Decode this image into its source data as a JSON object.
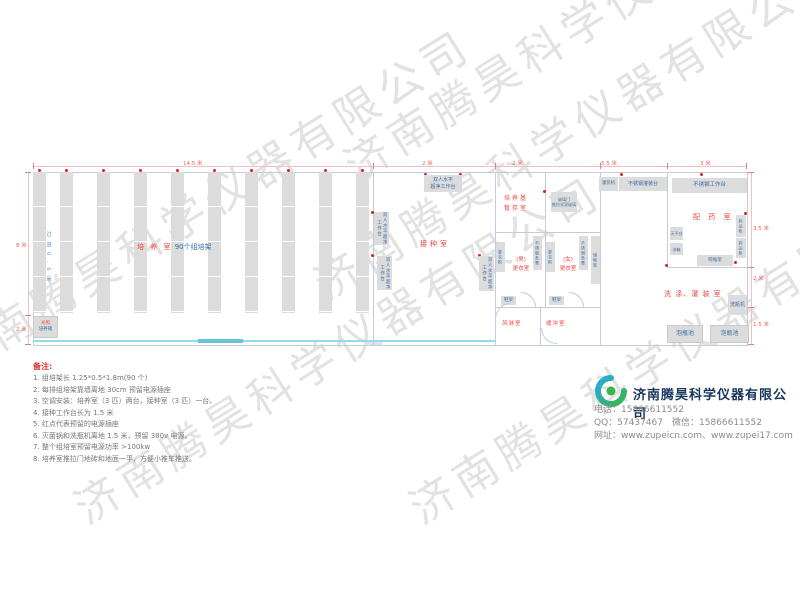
{
  "watermark": "济南腾昊科学仪器有限公司",
  "colors": {
    "room_label_red": "#f24545",
    "equipment_blue": "#3a6ea5",
    "dimension_red": "#e86060",
    "sliding_door_cyan": "#8fdde8",
    "company_navy": "#17365d",
    "logo_blue": "#29abe2",
    "logo_green": "#39b54a"
  },
  "plan": {
    "dims": {
      "top": [
        "14.5 米",
        "2 米",
        "2 米",
        "5.5 米",
        "3 米"
      ],
      "left": [
        "8 米",
        "2 米"
      ],
      "right": [
        "3.5 米",
        "2 米",
        "1.5 米"
      ]
    },
    "culture": {
      "name": "培 养 室",
      "racks": "90个组培架",
      "aisle": "过道0.6米",
      "incubator1": "光照",
      "incubator2": "培养箱"
    },
    "inoculation": {
      "name": "接种室",
      "bench1": "双人水平",
      "bench2": "超净工作台",
      "bench_v": "双人水平超净工作台"
    },
    "medium_storage": {
      "line1": "培养基",
      "line2": "暂存室"
    },
    "glass_door": {
      "line1": "玻璃门",
      "line2": "推拉式双玻璃"
    },
    "changing": {
      "wardrobe": "更衣柜",
      "steel_bench": "不锈钢条凳",
      "men1": "(男)",
      "men2": "更衣室",
      "women1": "(女)",
      "women2": "更衣室",
      "shoe_rack": "鞋架",
      "storage_rack": "储物架",
      "air_shower": "风淋室",
      "buffer": "缓冲室"
    },
    "pharmacy": {
      "name": "配 药 室",
      "filling_machine": "灌装机",
      "filling_table": "不锈钢灌装台",
      "work_table": "不锈钢工作台",
      "balance_table": "天平台",
      "fridge": "冰箱",
      "medicine_cabinet": "药品柜",
      "bottle_rack": "晾瓶架"
    },
    "washing": {
      "name": "洗 涤、灌 装 室",
      "bottle_washer": "洗瓶机",
      "soak_pool": "泡瓶池"
    }
  },
  "notes": {
    "title": "备注:",
    "items": [
      "1. 组培架长 1.25*0.5*1.8m(90 个)",
      "2. 每排组培架靠墙离地 30cm 预留电源插座",
      "3. 空调安装：培养室（3 匹）两台，接种室（3 匹）一台。",
      "4. 接种工作台长为 1.5 米",
      "5. 红点代表预留的电源插座",
      "6. 灭菌锅和洗瓶机离地 1.5 米，预留 380v 电源。",
      "7. 整个组培室预留电源功率 >100kw",
      "8. 培养室推拉门地砖和地面一平，方便小推车推送。"
    ]
  },
  "company": {
    "name": "济南腾昊科学仪器有限公司",
    "phone": "电话：15866611552",
    "qq": "QQ：57437467　微信：15866611552",
    "website": "网址：www.zupeicn.com、www.zupei17.com"
  }
}
